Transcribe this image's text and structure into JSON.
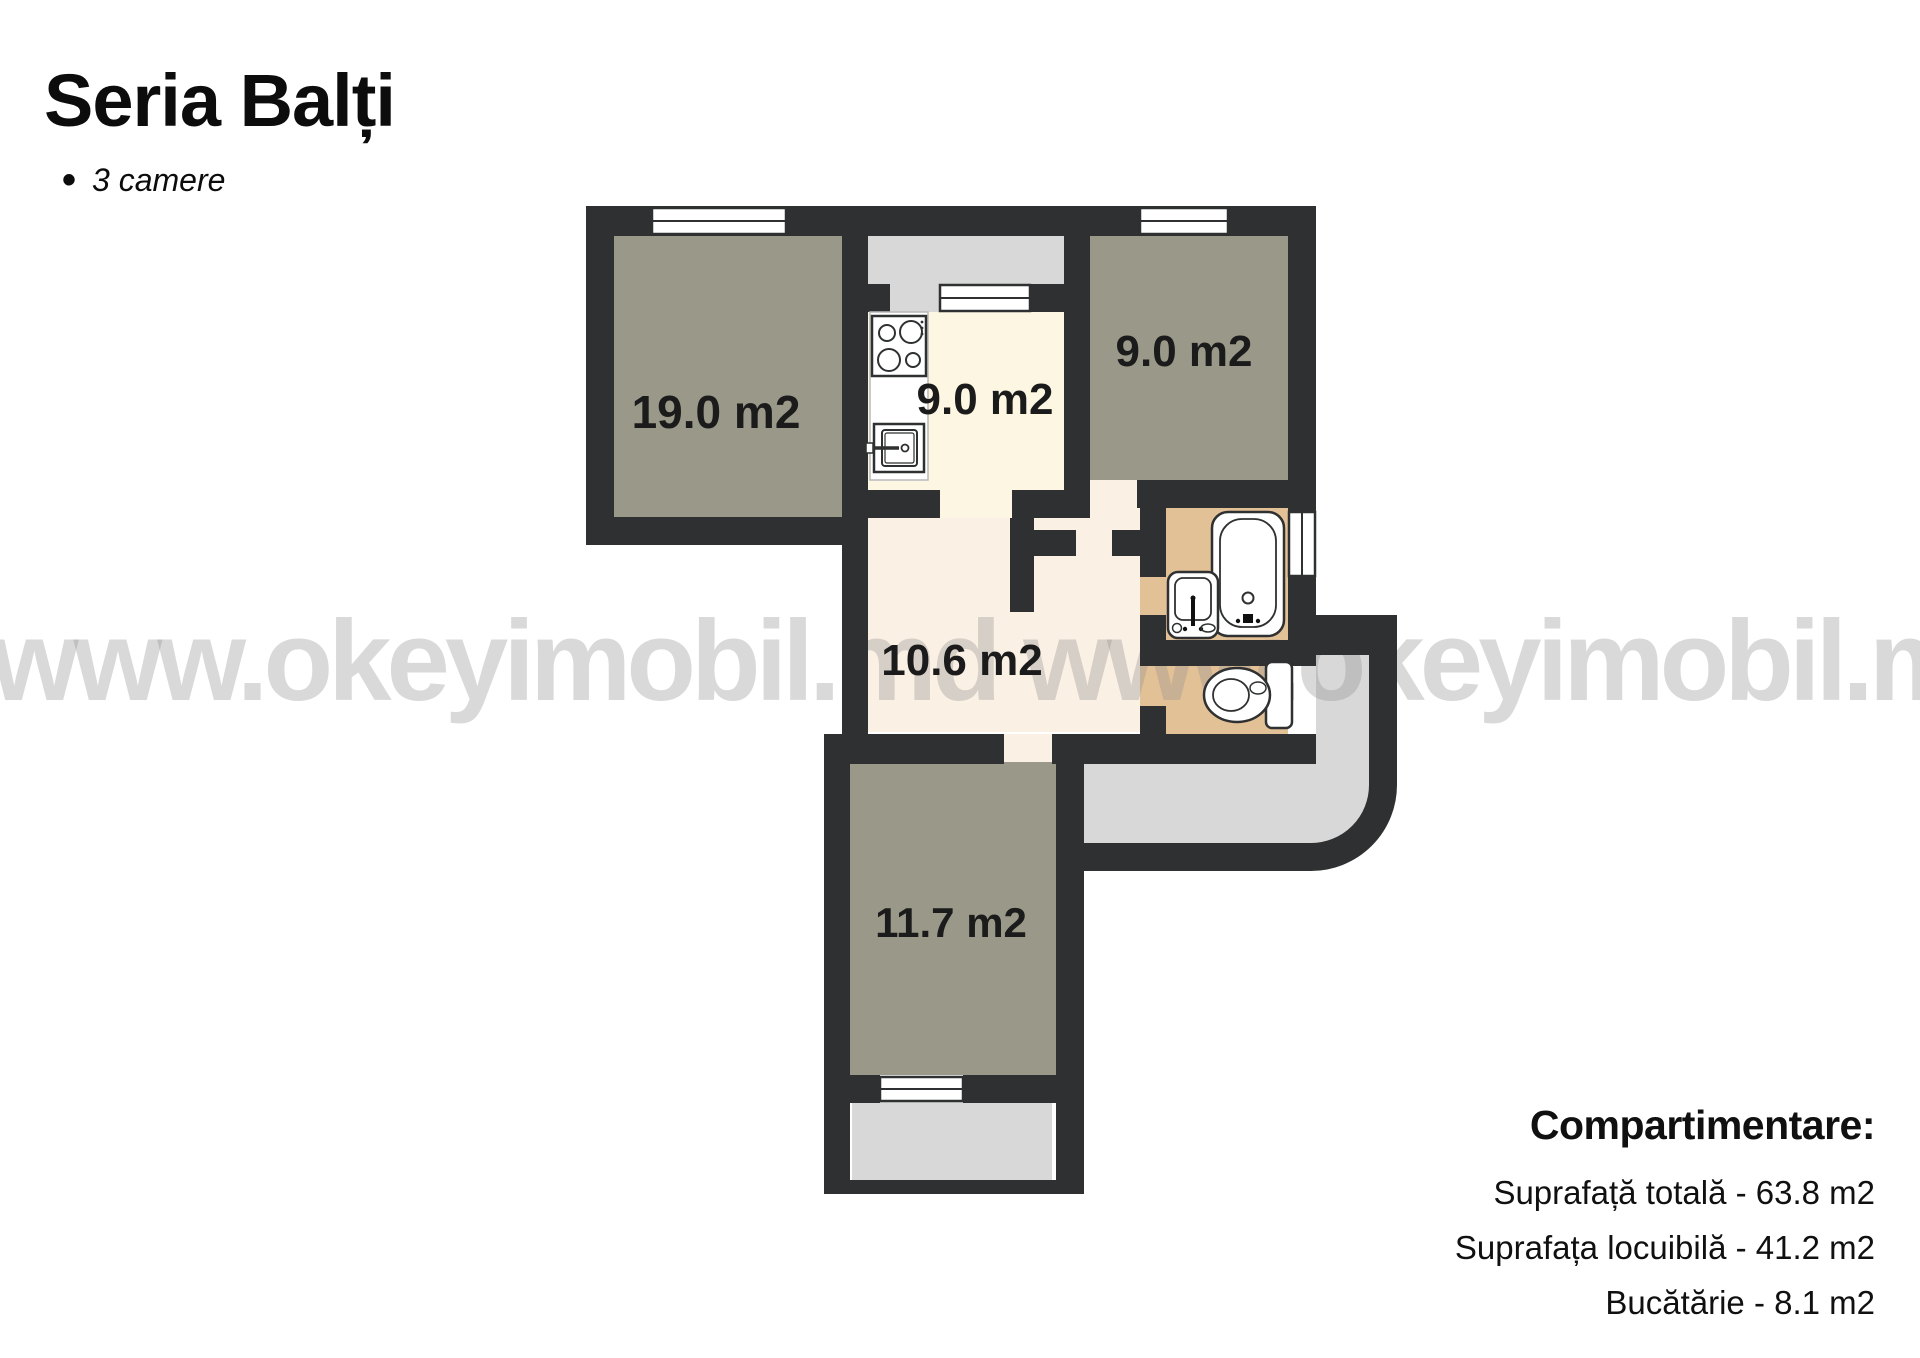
{
  "header": {
    "title": "Seria Balți",
    "bullet": "•",
    "subtitle": "3 camere"
  },
  "watermark": {
    "text": "www.okeyimobil.md www.okeyimobil.md"
  },
  "plan": {
    "rooms": [
      {
        "id": "living-room",
        "label": "19.0 m2"
      },
      {
        "id": "kitchen",
        "label": "9.0 m2"
      },
      {
        "id": "bedroom-top-right",
        "label": "9.0 m2"
      },
      {
        "id": "hallway",
        "label": "10.6 m2"
      },
      {
        "id": "bedroom-bottom",
        "label": "11.7 m2"
      }
    ],
    "colors": {
      "wall": "#2f3031",
      "room_fill": "#9a9889",
      "kitchen_fill": "#fcf6e2",
      "hallway_fill": "#faf0e4",
      "bath_fill": "#e3c196",
      "balcony_fill": "#d8d8d8",
      "window_fill": "#ffffff"
    }
  },
  "details": {
    "title": "Compartimentare:",
    "items": [
      "Suprafață totală - 63.8 m2",
      "Suprafața locuibilă - 41.2 m2",
      "Bucătărie - 8.1 m2"
    ]
  }
}
